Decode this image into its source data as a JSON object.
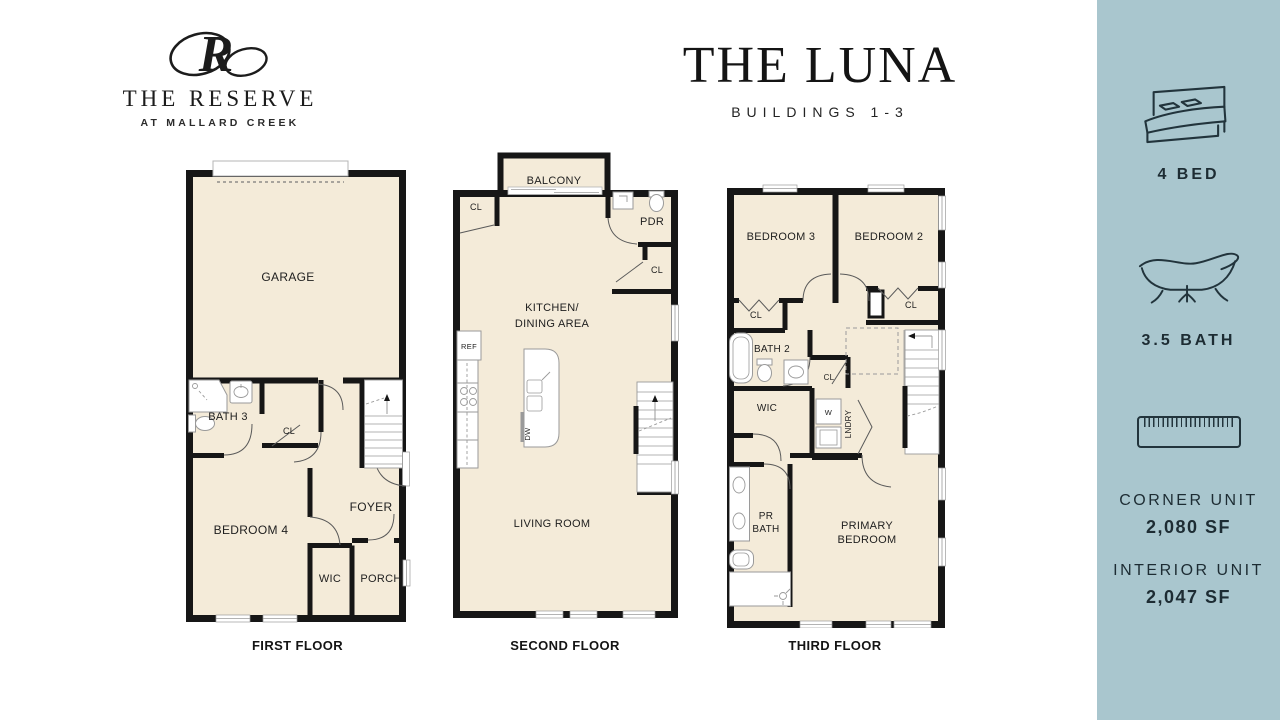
{
  "logo": {
    "monogram": "R",
    "name": "THE RESERVE",
    "tagline": "AT MALLARD CREEK"
  },
  "header": {
    "title": "THE LUNA",
    "subtitle": "BUILDINGS 1-3"
  },
  "sidebar": {
    "bed_label": "4 BED",
    "bath_label": "3.5 BATH",
    "corner_unit_label": "CORNER UNIT",
    "corner_unit_size": "2,080 SF",
    "interior_unit_label": "INTERIOR UNIT",
    "interior_unit_size": "2,047 SF"
  },
  "floor1": {
    "name": "FIRST FLOOR",
    "garage": "GARAGE",
    "bath": "BATH 3",
    "cl": "CL",
    "bedroom": "BEDROOM 4",
    "foyer": "FOYER",
    "wic": "WIC",
    "porch": "PORCH"
  },
  "floor2": {
    "name": "SECOND FLOOR",
    "balcony": "BALCONY",
    "cl_left": "CL",
    "pdr": "PDR",
    "cl_right": "CL",
    "kitchen1": "KITCHEN/",
    "kitchen2": "DINING AREA",
    "ref": "REF",
    "dw": "DW",
    "living": "LIVING ROOM"
  },
  "floor3": {
    "name": "THIRD FLOOR",
    "bedroom3": "BEDROOM 3",
    "bedroom2": "BEDROOM 2",
    "cl_left": "CL",
    "cl_right": "CL",
    "bath2": "BATH 2",
    "cl_mid": "CL",
    "wic": "WIC",
    "washer": "W",
    "lndry": "LNDRY",
    "prbath1": "PR",
    "prbath2": "BATH",
    "primary1": "PRIMARY",
    "primary2": "BEDROOM"
  },
  "colors": {
    "sidebar_bg": "#a9c6ce",
    "plan_fill": "#f4ebd9",
    "wall": "#161616",
    "text": "#1d2c33"
  }
}
